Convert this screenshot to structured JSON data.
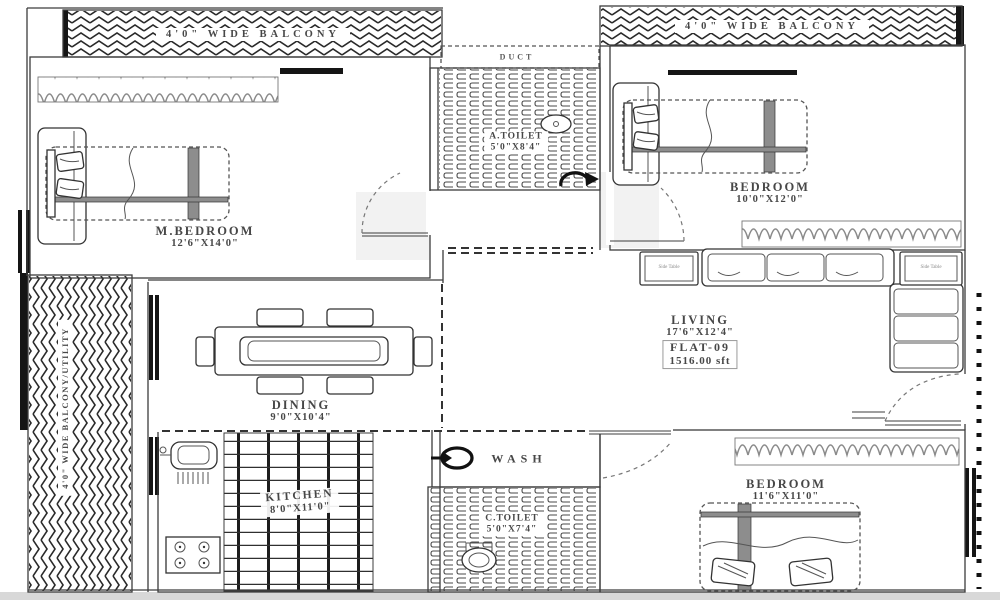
{
  "colors": {
    "ink": "#3c3c3c",
    "text": "#474747",
    "wall_fill": "#151515",
    "paper": "#ffffff",
    "bottom_strip": "#d8d8d8"
  },
  "rooms": {
    "balcony_top_left": {
      "name": "4'0\" WIDE BALCONY"
    },
    "balcony_top_right": {
      "name": "4'0\" WIDE BALCONY"
    },
    "balcony_left": {
      "name": "4'0\" WIDE BALCONY/UTILITY"
    },
    "duct": {
      "name": "DUCT"
    },
    "a_toilet": {
      "name": "A.TOILET",
      "dims": "5'0\"X8'4\""
    },
    "m_bedroom": {
      "name": "M.BEDROOM",
      "dims": "12'6\"X14'0\""
    },
    "bedroom_top_right": {
      "name": "BEDROOM",
      "dims": "10'0\"X12'0\""
    },
    "living": {
      "name": "LIVING",
      "dims": "17'6\"X12'4\"",
      "flat_label": "FLAT-09",
      "area_label": "1516.00 sft"
    },
    "dining": {
      "name": "DINING",
      "dims": "9'0\"X10'4\""
    },
    "kitchen": {
      "name": "KITCHEN",
      "dims": "8'0\"X11'0\""
    },
    "wash": {
      "name": "WASH"
    },
    "c_toilet": {
      "name": "C.TOILET",
      "dims": "5'0\"X7'4\""
    },
    "bedroom_bottom_right": {
      "name": "BEDROOM",
      "dims": "11'6\"X11'0\""
    }
  },
  "furniture": {
    "side_table_label": "Side Table"
  }
}
